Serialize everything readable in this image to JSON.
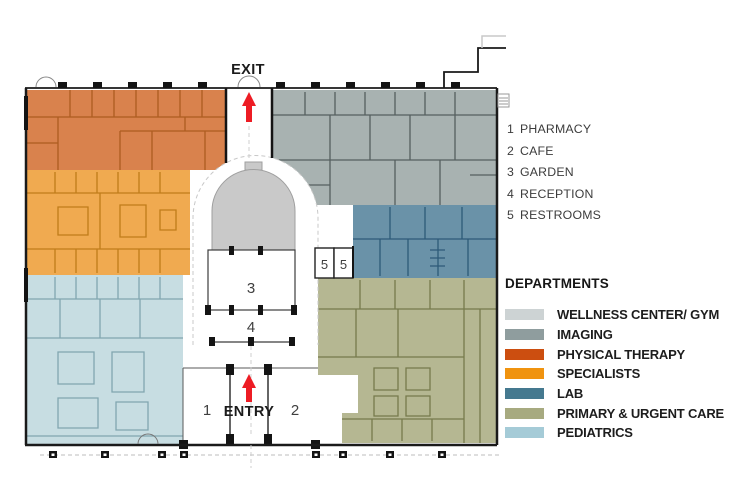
{
  "plan_labels": {
    "exit": "EXIT",
    "entry": "ENTRY",
    "room1": "1",
    "room2": "2",
    "room3": "3",
    "room4": "4",
    "restroom_number": "5"
  },
  "key": {
    "items": [
      {
        "num": "1",
        "label": "PHARMACY"
      },
      {
        "num": "2",
        "label": "CAFE"
      },
      {
        "num": "3",
        "label": "GARDEN"
      },
      {
        "num": "4",
        "label": "RECEPTION"
      },
      {
        "num": "5",
        "label": "RESTROOMS"
      }
    ]
  },
  "departments": {
    "title": "DEPARTMENTS",
    "items": [
      {
        "label": "WELLNESS CENTER/ GYM",
        "color": "#cdd3d4"
      },
      {
        "label": "IMAGING",
        "color": "#8f9d9e"
      },
      {
        "label": "PHYSICAL THERAPY",
        "color": "#cc4e10"
      },
      {
        "label": "SPECIALISTS",
        "color": "#f0930f"
      },
      {
        "label": "LAB",
        "color": "#45798f"
      },
      {
        "label": "PRIMARY & URGENT CARE",
        "color": "#a7aa80"
      },
      {
        "label": "PEDIATRICS",
        "color": "#a5cbd7"
      }
    ]
  },
  "colors": {
    "plan": {
      "pt_fill": "#d9824d",
      "pt_wall": "#ad5c20",
      "spec_fill": "#f0aa50",
      "spec_wall": "#c07c1a",
      "ped_fill": "#c7dde2",
      "ped_wall": "#81a6b0",
      "img_fill": "#a8b2b1",
      "img_wall": "#55605f",
      "lab_fill": "#6a92a8",
      "lab_wall": "#2d5a78",
      "pri_fill": "#b5b792",
      "pri_wall": "#767a4c",
      "dome_fill": "#c9c9c9",
      "arrow": "#ed1c24",
      "outline": "#1a1a1a"
    }
  }
}
